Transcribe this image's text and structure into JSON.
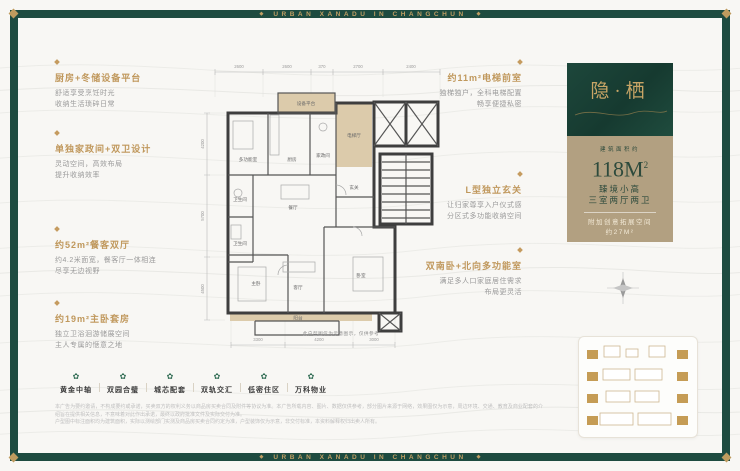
{
  "frame": {
    "banner_text": "URBAN XANADU IN CHANGCHUN",
    "diamond_icon": "◆"
  },
  "left_annotations": [
    {
      "title": "厨房+冬储设备平台",
      "line1": "舒适享受烹饪时光",
      "line2": "收纳生活琐碎日常"
    },
    {
      "title": "单独家政间+双卫设计",
      "line1": "灵动空间，高效布局",
      "line2": "提升收纳效率"
    },
    {
      "title": "约52m²餐客双厅",
      "line1": "约4.2米面宽，餐客厅一体相连",
      "line2": "尽享无边视野"
    },
    {
      "title": "约19m²主卧套房",
      "line1": "独立卫浴洄游储展空间",
      "line2": "主人专属的惬意之地"
    }
  ],
  "right_annotations": [
    {
      "title": "约11m²电梯前室",
      "line1": "独梯独户，全科电梯配置",
      "line2": "畅享便捷私密"
    },
    {
      "title": "L型独立玄关",
      "line1": "让归家尊享入户仪式感",
      "line2": "分区式多功能收纳空间"
    },
    {
      "title": "双南卧+北向多功能室",
      "line1": "满足多人口家庭居住需求",
      "line2": "布局更灵活"
    }
  ],
  "info_panel": {
    "name": "隐·栖",
    "area_label": "建筑面积约",
    "area_value": "118M",
    "area_sup": "2",
    "spec_line1": "臻境小高",
    "spec_line2": "三室两厅两卫",
    "bonus_line1": "附加创意拓展空间",
    "bonus_line2": "约27M²"
  },
  "floorplan": {
    "rooms": {
      "equipment": "设备平台",
      "elevator_hall": "电梯厅",
      "multi": "多功能室",
      "kitchen": "厨房",
      "laundry": "家政间",
      "bath1": "卫生间",
      "bath2": "卫生间",
      "dining": "餐厅",
      "foyer": "玄关",
      "living": "客厅",
      "master": "主卧",
      "bedroom": "卧室",
      "balcony": "阳台"
    },
    "dims_top": [
      "2600",
      "2600",
      "370",
      "2700",
      "2400"
    ],
    "dims_left": [
      "4200",
      "5700",
      "4500"
    ],
    "dims_bottom": [
      "3300",
      "4200",
      "3000"
    ],
    "caption": "此户型图仅为示意图示，仅供参考"
  },
  "features": {
    "icon_glyph": "✿",
    "items": [
      {
        "label": "黄金中轴"
      },
      {
        "label": "双园合璧"
      },
      {
        "label": "城芯配套"
      },
      {
        "label": "双轨交汇"
      },
      {
        "label": "低密住区"
      },
      {
        "label": "万科物业"
      }
    ]
  },
  "disclaimer": {
    "line1": "本广告为要约邀请，不构成要约或承诺，买卖双方的权利义务以商品房买卖合同及附件等协议为准。本广告所载内容、图片、数据仅供参考，部分图片来源于网络，效果图仅为示意，周边环境、交通、教育及商业配套的介绍旨在提供相关信息，不意味着对此作出承诺，最终以政府批准文件及实际交付为准。",
    "line2": "户型图中标注面积均为建筑面积，实际以测绘部门实测及商品房买卖合同约定为准，户型装饰仅为示意，非交付标准，本资料解释权归出卖人所有。"
  }
}
